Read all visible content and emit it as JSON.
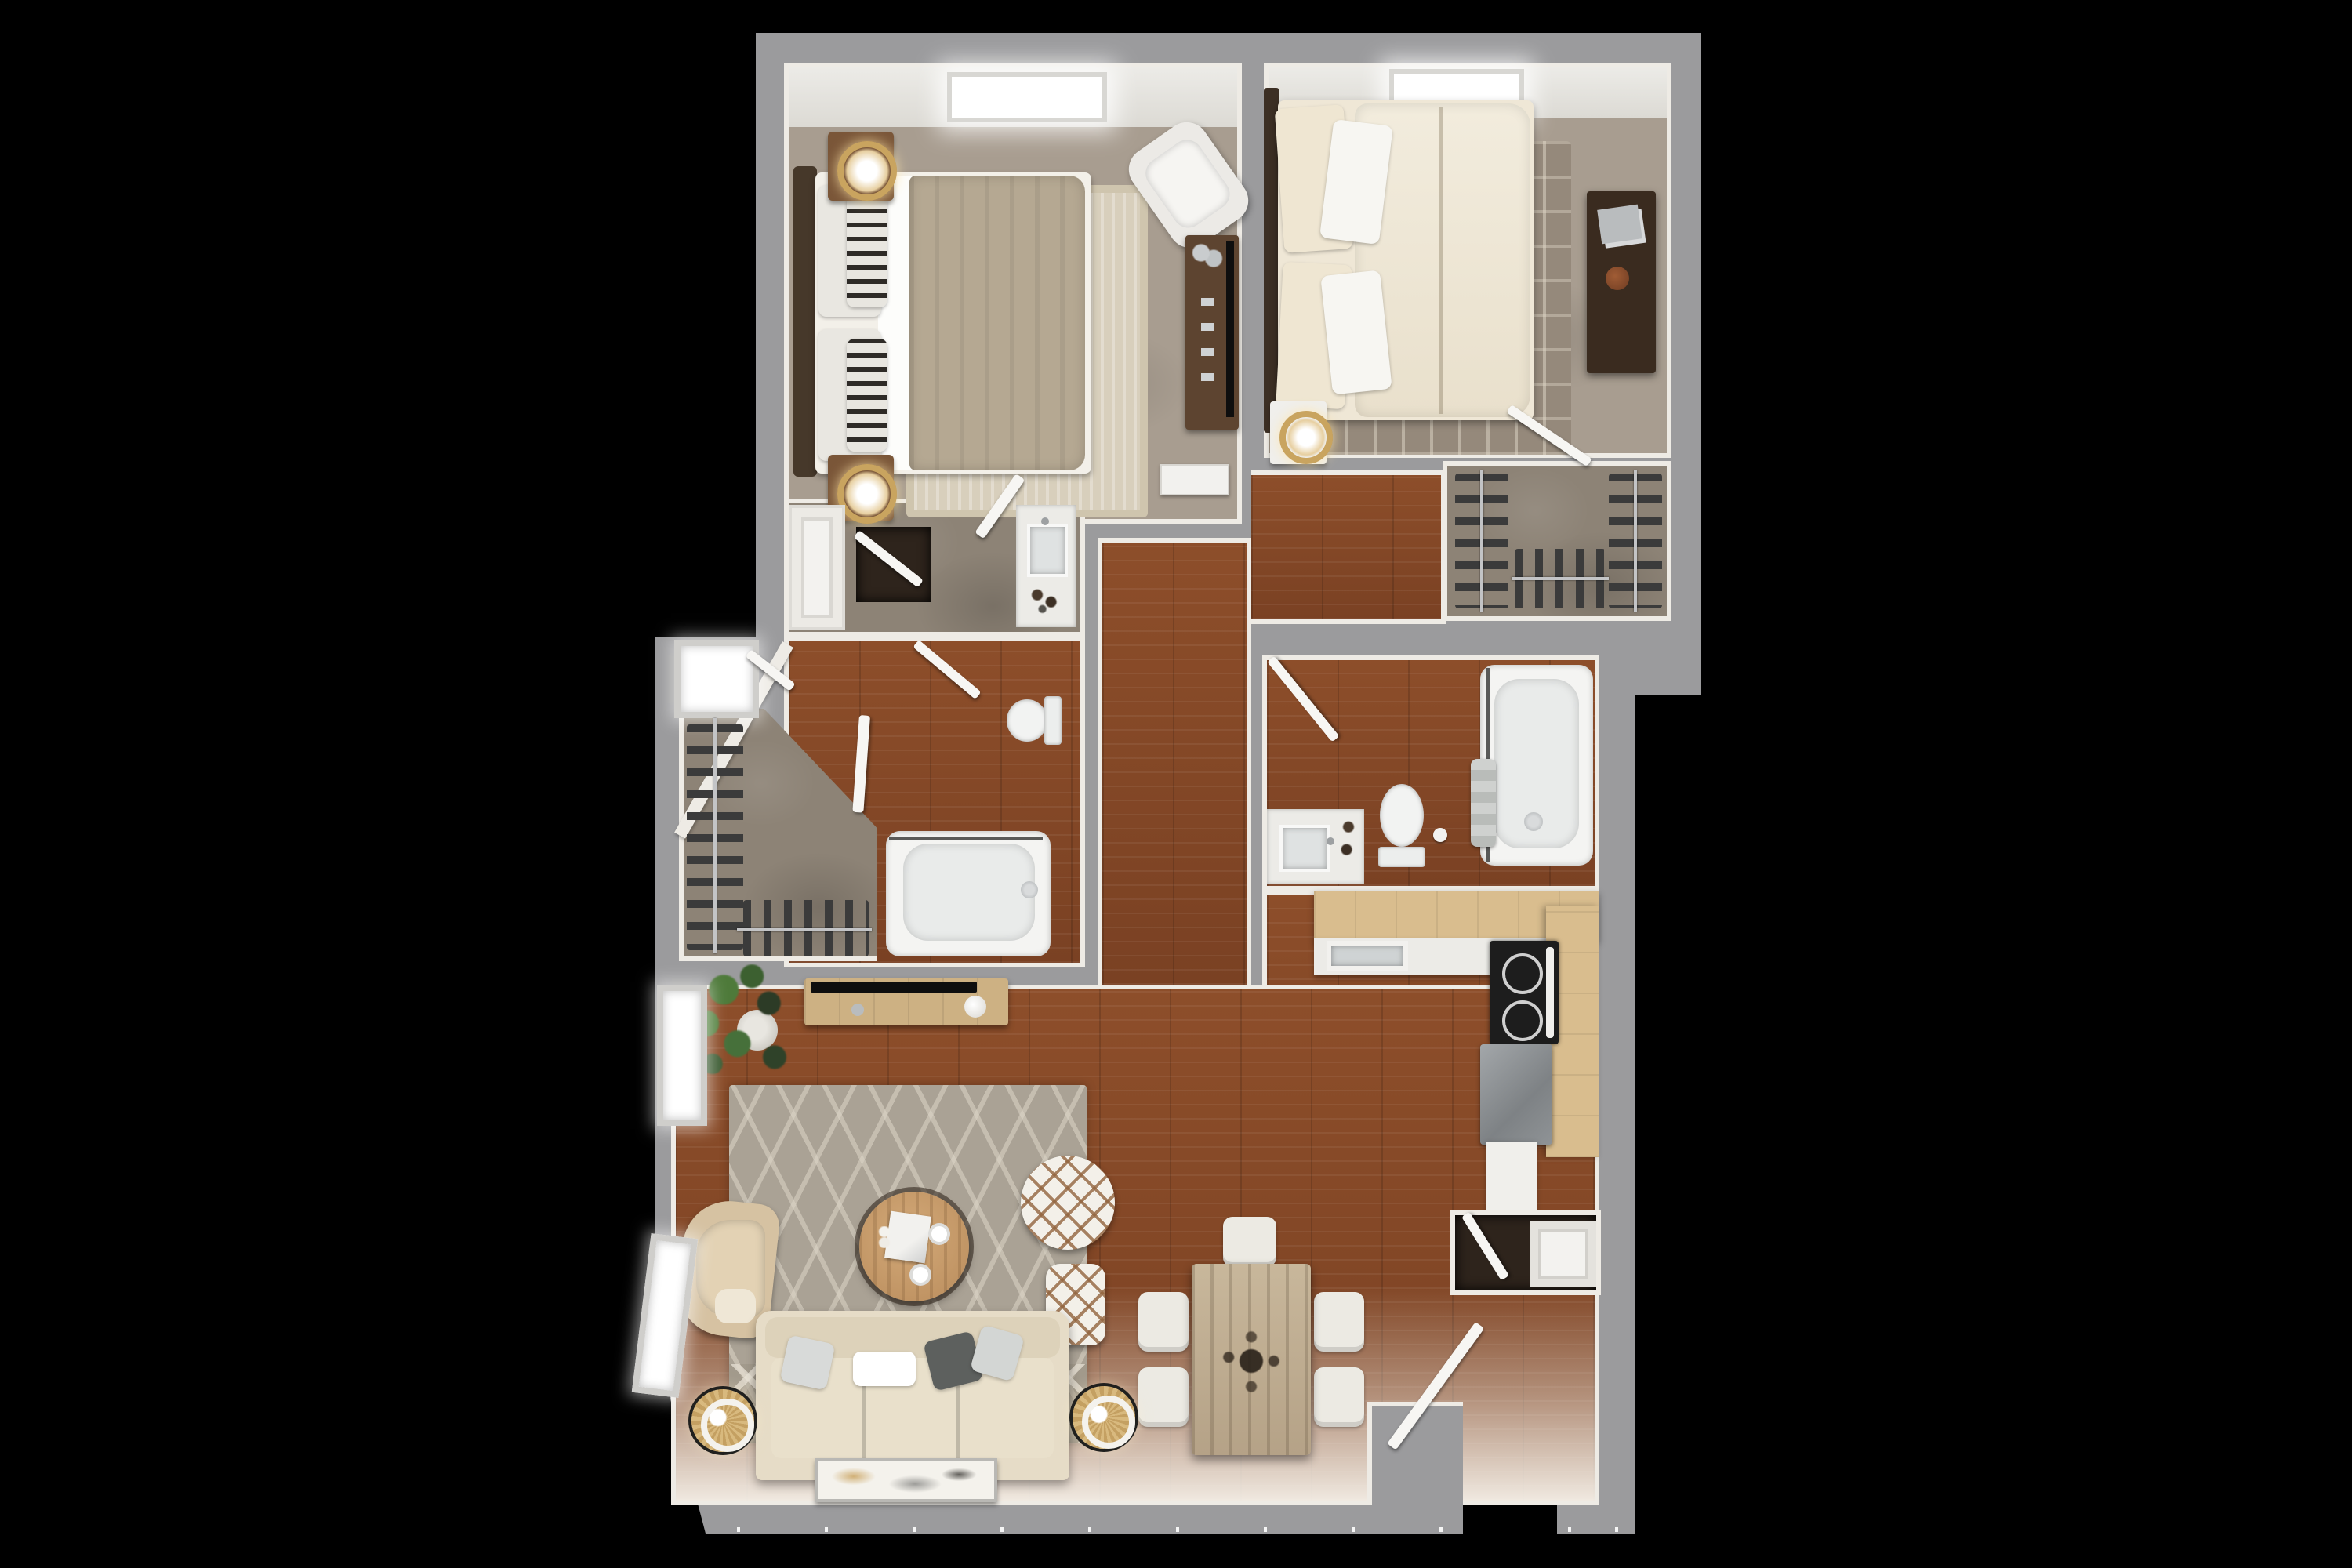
{
  "image_type": "3D rendered apartment floor plan, top-down view, no visible text",
  "background_color": "#000000",
  "palette": {
    "outer_wall": "#9b9b9d",
    "wall_face": "#eeebe5",
    "bedroom_carpet": "#a89d90",
    "closet_concrete": "#8d8376",
    "hardwood_dark": "#8d4e2a",
    "hardwood_shadow": "#7a4123",
    "kitchen_maple_counter": "#d9bd8e",
    "white_counter": "#ecebe7",
    "fixture_white": "#f4f4f2",
    "sofa_cream": "#e6dcc7",
    "rug_gray": "#aaa295",
    "accent_gold": "#c9a45f",
    "stainless_steel": "#93979a",
    "tv_black": "#0e0e0e",
    "plant_green": "#4e7a3a"
  },
  "rooms": [
    {
      "name": "bedroom-1",
      "floor": "carpet",
      "furniture": [
        "bed with dark frame and taupe throw",
        "striped pillows",
        "nightstand x2",
        "gold ring lamp x2",
        "cream area rug",
        "white accent chair",
        "media dresser with tv",
        "baseboard heater",
        "ceiling light"
      ]
    },
    {
      "name": "bedroom-2",
      "floor": "carpet",
      "furniture": [
        "bed with cream duvet",
        "white pillows",
        "patterned area rug",
        "dark dresser with books and clay pot",
        "white nightstand with gold lamp",
        "ceiling light",
        "open door"
      ]
    },
    {
      "name": "walk-in-closet-1",
      "floor": "concrete",
      "furniture": [
        "clothes rod left with 10 hangers",
        "clothes rod bottom with 6 hangers",
        "window bay"
      ]
    },
    {
      "name": "walk-in-closet-2",
      "floor": "concrete",
      "furniture": [
        "clothes rod left",
        "clothes rod right",
        "clothes rod bottom"
      ]
    },
    {
      "name": "vanity-hall",
      "floor": "concrete",
      "furniture": [
        "vanity with sink",
        "linen closet doors",
        "dark closet nook",
        "open door"
      ]
    },
    {
      "name": "bathroom-1",
      "floor": "hardwood",
      "furniture": [
        "bathtub with shower rod",
        "toilet",
        "open doors",
        "diagonal wall"
      ]
    },
    {
      "name": "bathroom-2",
      "floor": "hardwood",
      "furniture": [
        "bathtub with towels and shower rod",
        "toilet",
        "vanity with sink",
        "open door"
      ]
    },
    {
      "name": "hallway",
      "floor": "hardwood",
      "furniture": []
    },
    {
      "name": "kitchen",
      "floor": "hardwood",
      "furniture": [
        "L-shaped maple counters",
        "kitchen sink",
        "range with black cooktop",
        "stainless appliance",
        "white base cabinet"
      ]
    },
    {
      "name": "dining-area",
      "floor": "hardwood",
      "furniture": [
        "rustic wood dining table",
        "dining chair x5",
        "dark sprig centerpiece"
      ]
    },
    {
      "name": "living-room",
      "floor": "hardwood",
      "furniture": [
        "cream sofa with 4 pillows",
        "rattan floor lamp x2",
        "round wood coffee table with tray and cups",
        "round lattice pouf",
        "square lattice pouf",
        "tan accent chair",
        "media console with tv and vase",
        "potted plant",
        "gray diamond rug with chevron band",
        "leaning floor art",
        "window x2"
      ]
    },
    {
      "name": "entry",
      "floor": "hardwood",
      "furniture": [
        "open front door",
        "coat closet with paneled door",
        "entry vestibule wall"
      ]
    }
  ],
  "door_count": 10,
  "skylight_count": 2
}
